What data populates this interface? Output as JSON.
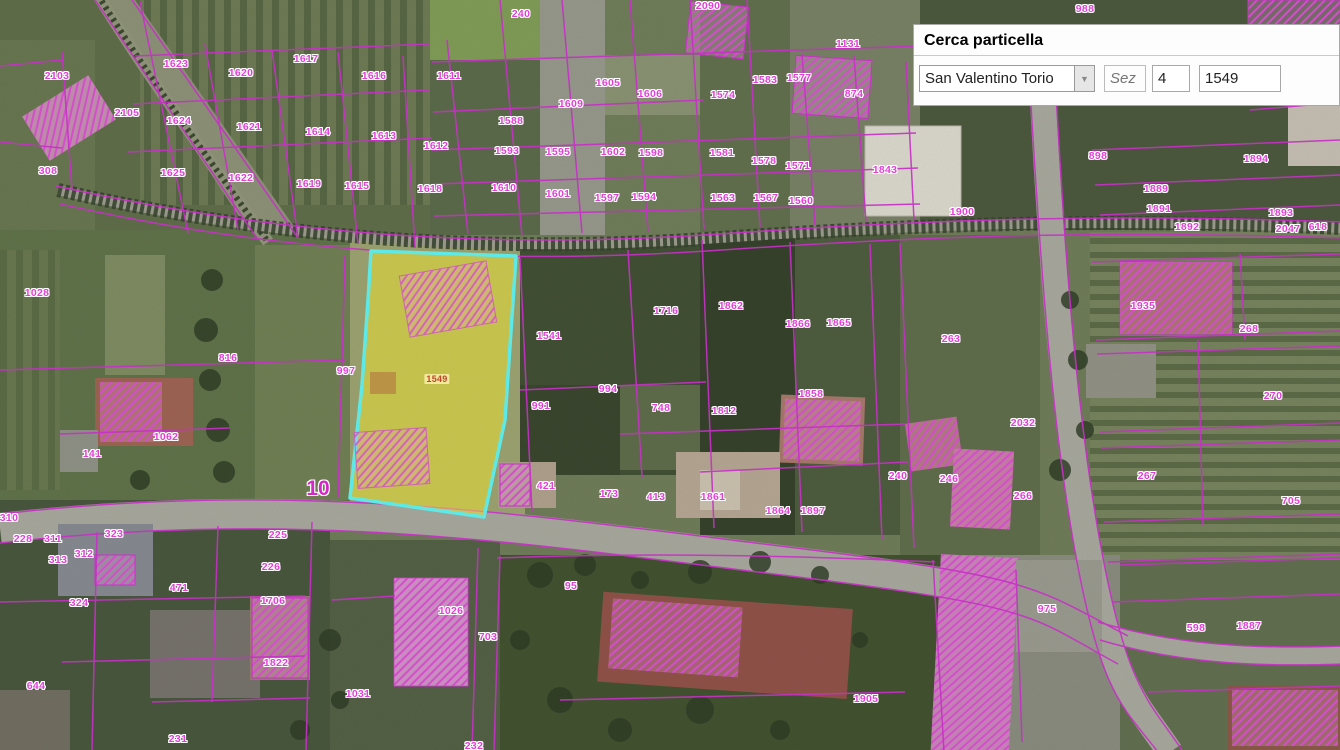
{
  "search_panel": {
    "title": "Cerca particella",
    "comune": "San Valentino Torio",
    "sez_placeholder": "Sez",
    "foglio": "4",
    "particella": "1549"
  },
  "map": {
    "label_color": "#e23fd8",
    "line_color": "#cb30cb",
    "highlighted_parcel": {
      "number": "1549",
      "fill": "#eade34",
      "stroke": "#5fe9e6"
    },
    "labels": [
      {
        "text": "2103",
        "x": 57,
        "y": 76
      },
      {
        "text": "2105",
        "x": 127,
        "y": 113
      },
      {
        "text": "1623",
        "x": 176,
        "y": 64
      },
      {
        "text": "1620",
        "x": 241,
        "y": 73
      },
      {
        "text": "1617",
        "x": 306,
        "y": 59
      },
      {
        "text": "1616",
        "x": 374,
        "y": 76
      },
      {
        "text": "1624",
        "x": 179,
        "y": 121
      },
      {
        "text": "1621",
        "x": 249,
        "y": 127
      },
      {
        "text": "1614",
        "x": 318,
        "y": 132
      },
      {
        "text": "1613",
        "x": 384,
        "y": 136
      },
      {
        "text": "308",
        "x": 48,
        "y": 171
      },
      {
        "text": "1625",
        "x": 173,
        "y": 173
      },
      {
        "text": "1622",
        "x": 241,
        "y": 178
      },
      {
        "text": "1619",
        "x": 309,
        "y": 184
      },
      {
        "text": "1615",
        "x": 357,
        "y": 186
      },
      {
        "text": "1618",
        "x": 430,
        "y": 189
      },
      {
        "text": "240",
        "x": 521,
        "y": 14
      },
      {
        "text": "2090",
        "x": 708,
        "y": 6
      },
      {
        "text": "988",
        "x": 1085,
        "y": 9
      },
      {
        "text": "1131",
        "x": 848,
        "y": 44
      },
      {
        "text": "1611",
        "x": 449,
        "y": 76
      },
      {
        "text": "1605",
        "x": 608,
        "y": 83
      },
      {
        "text": "1606",
        "x": 650,
        "y": 94
      },
      {
        "text": "1609",
        "x": 571,
        "y": 104
      },
      {
        "text": "1588",
        "x": 511,
        "y": 121
      },
      {
        "text": "1612",
        "x": 436,
        "y": 146
      },
      {
        "text": "1593",
        "x": 507,
        "y": 151
      },
      {
        "text": "1595",
        "x": 558,
        "y": 152
      },
      {
        "text": "1602",
        "x": 613,
        "y": 152
      },
      {
        "text": "1598",
        "x": 651,
        "y": 153
      },
      {
        "text": "1610",
        "x": 504,
        "y": 188
      },
      {
        "text": "1601",
        "x": 558,
        "y": 194
      },
      {
        "text": "1597",
        "x": 607,
        "y": 198
      },
      {
        "text": "1594",
        "x": 644,
        "y": 197
      },
      {
        "text": "1583",
        "x": 765,
        "y": 80
      },
      {
        "text": "1577",
        "x": 799,
        "y": 78
      },
      {
        "text": "1574",
        "x": 723,
        "y": 95
      },
      {
        "text": "874",
        "x": 854,
        "y": 94
      },
      {
        "text": "1581",
        "x": 722,
        "y": 153
      },
      {
        "text": "1578",
        "x": 764,
        "y": 161
      },
      {
        "text": "1571",
        "x": 798,
        "y": 166
      },
      {
        "text": "1563",
        "x": 723,
        "y": 198
      },
      {
        "text": "1567",
        "x": 766,
        "y": 198
      },
      {
        "text": "1560",
        "x": 801,
        "y": 201
      },
      {
        "text": "1843",
        "x": 885,
        "y": 170
      },
      {
        "text": "1900",
        "x": 962,
        "y": 212
      },
      {
        "text": "898",
        "x": 1098,
        "y": 156
      },
      {
        "text": "1894",
        "x": 1256,
        "y": 159
      },
      {
        "text": "1889",
        "x": 1156,
        "y": 189
      },
      {
        "text": "1891",
        "x": 1159,
        "y": 209
      },
      {
        "text": "1892",
        "x": 1187,
        "y": 227
      },
      {
        "text": "1893",
        "x": 1281,
        "y": 213
      },
      {
        "text": "2047",
        "x": 1288,
        "y": 229
      },
      {
        "text": "618",
        "x": 1318,
        "y": 227
      },
      {
        "text": "1028",
        "x": 37,
        "y": 293
      },
      {
        "text": "816",
        "x": 228,
        "y": 358
      },
      {
        "text": "997",
        "x": 346,
        "y": 371
      },
      {
        "text": "1541",
        "x": 549,
        "y": 336
      },
      {
        "text": "1716",
        "x": 666,
        "y": 311
      },
      {
        "text": "1862",
        "x": 731,
        "y": 306
      },
      {
        "text": "1866",
        "x": 798,
        "y": 324
      },
      {
        "text": "1865",
        "x": 839,
        "y": 323
      },
      {
        "text": "263",
        "x": 951,
        "y": 339
      },
      {
        "text": "1935",
        "x": 1143,
        "y": 306
      },
      {
        "text": "268",
        "x": 1249,
        "y": 329
      },
      {
        "text": "270",
        "x": 1273,
        "y": 396
      },
      {
        "text": "991",
        "x": 541,
        "y": 406
      },
      {
        "text": "994",
        "x": 608,
        "y": 389
      },
      {
        "text": "748",
        "x": 661,
        "y": 408
      },
      {
        "text": "1858",
        "x": 811,
        "y": 394
      },
      {
        "text": "1812",
        "x": 724,
        "y": 411
      },
      {
        "text": "1062",
        "x": 166,
        "y": 437
      },
      {
        "text": "141",
        "x": 92,
        "y": 454
      },
      {
        "text": "2032",
        "x": 1023,
        "y": 423
      },
      {
        "text": "240",
        "x": 898,
        "y": 476
      },
      {
        "text": "246",
        "x": 949,
        "y": 479
      },
      {
        "text": "266",
        "x": 1023,
        "y": 496
      },
      {
        "text": "267",
        "x": 1147,
        "y": 476
      },
      {
        "text": "705",
        "x": 1291,
        "y": 501
      },
      {
        "text": "421",
        "x": 546,
        "y": 486
      },
      {
        "text": "173",
        "x": 609,
        "y": 494
      },
      {
        "text": "413",
        "x": 656,
        "y": 497
      },
      {
        "text": "1861",
        "x": 713,
        "y": 497
      },
      {
        "text": "1864",
        "x": 778,
        "y": 511
      },
      {
        "text": "1897",
        "x": 813,
        "y": 511
      },
      {
        "text": "310",
        "x": 9,
        "y": 518
      },
      {
        "text": "228",
        "x": 23,
        "y": 539
      },
      {
        "text": "311",
        "x": 53,
        "y": 539
      },
      {
        "text": "312",
        "x": 84,
        "y": 554
      },
      {
        "text": "313",
        "x": 58,
        "y": 560
      },
      {
        "text": "323",
        "x": 114,
        "y": 534
      },
      {
        "text": "225",
        "x": 278,
        "y": 535
      },
      {
        "text": "226",
        "x": 271,
        "y": 567
      },
      {
        "text": "1706",
        "x": 273,
        "y": 601
      },
      {
        "text": "471",
        "x": 179,
        "y": 588
      },
      {
        "text": "324",
        "x": 79,
        "y": 603
      },
      {
        "text": "644",
        "x": 36,
        "y": 686
      },
      {
        "text": "1822",
        "x": 276,
        "y": 663
      },
      {
        "text": "231",
        "x": 178,
        "y": 739
      },
      {
        "text": "1031",
        "x": 358,
        "y": 694
      },
      {
        "text": "1026",
        "x": 451,
        "y": 611
      },
      {
        "text": "703",
        "x": 488,
        "y": 637
      },
      {
        "text": "95",
        "x": 571,
        "y": 586
      },
      {
        "text": "232",
        "x": 474,
        "y": 746
      },
      {
        "text": "1905",
        "x": 866,
        "y": 699
      },
      {
        "text": "975",
        "x": 1047,
        "y": 609
      },
      {
        "text": "598",
        "x": 1196,
        "y": 628
      },
      {
        "text": "1887",
        "x": 1249,
        "y": 626
      },
      {
        "text": "1549",
        "x": 437,
        "y": 379,
        "style": "highlight-ref"
      },
      {
        "text": "10",
        "x": 318,
        "y": 489,
        "style": "road"
      }
    ]
  }
}
